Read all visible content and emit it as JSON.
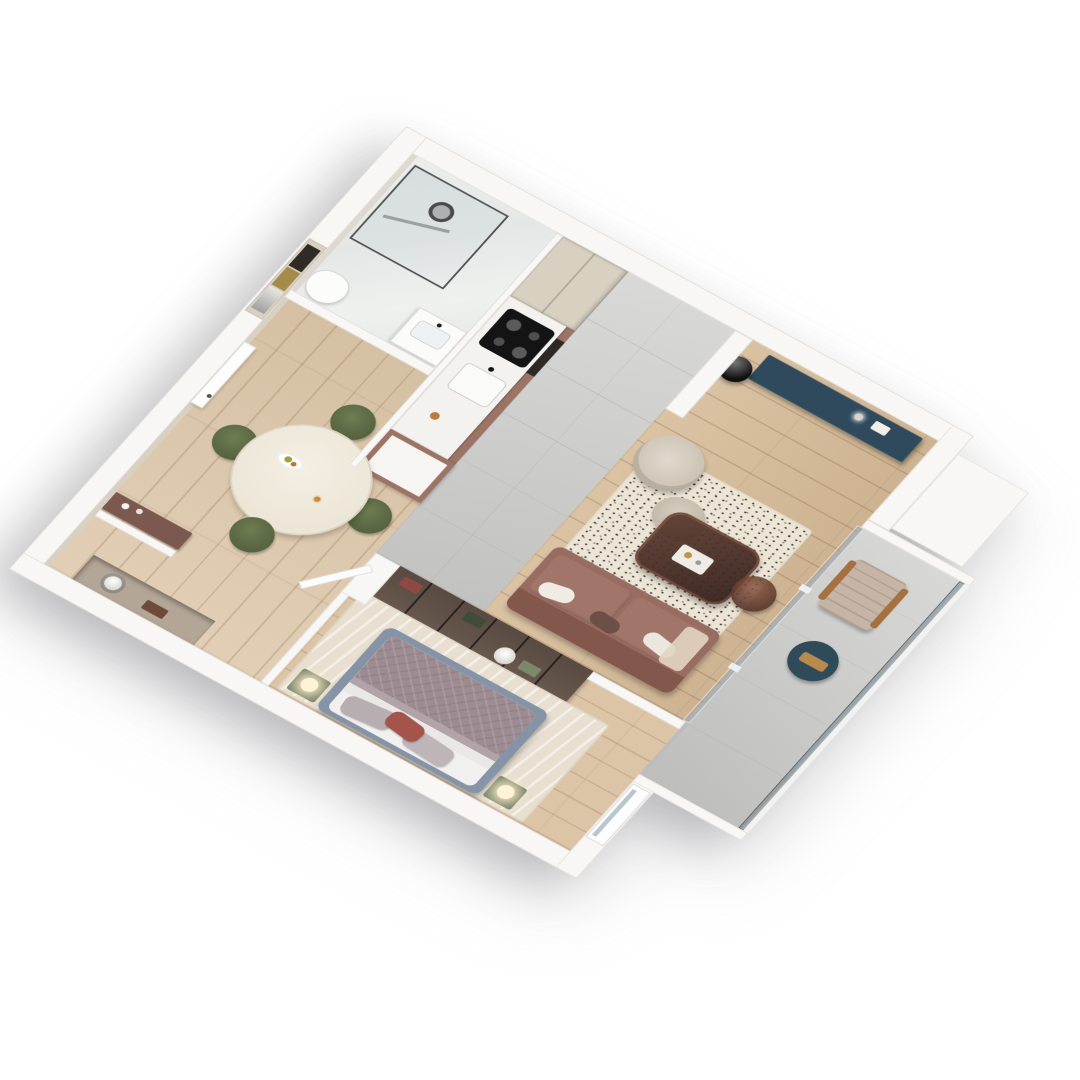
{
  "meta": {
    "type": "isometric-3d-floor-plan-render",
    "description": "Photorealistic 3D cutaway floor plan of a one-bedroom apartment viewed from above at an angle, white exterior walls, on a plain white background",
    "visible_text": "none"
  },
  "palette": {
    "wall": "#f8f7f5",
    "wallEdge": "#e1dfdb",
    "beigeWall": "#d8d0c0",
    "accentWall": "#aba49a",
    "concrete": "#cccccb",
    "woodHall": "#dcc6a8",
    "woodLiving": "#d5ba97",
    "woodBed": "#dcc4a7",
    "navy": "#2e4a5c",
    "sofa": "#986c60",
    "greenChair": "#5c6a45",
    "cream": "#d8d0c3",
    "rug": "#ece5d6",
    "bedRug": "#e8dfd1",
    "bedFrame": "#8493a6",
    "blanket": "#9c8b91",
    "redPillow": "#a5544c",
    "wardrobe": "#7a675a",
    "coffee": "#4e342c",
    "tower": "#9b7466",
    "counter": "#f3f2ee",
    "cab": "#d8d0c1",
    "balconyTable": "#2f4a59",
    "consoleBrown": "#7b5950",
    "niche": "#b4a697",
    "glass": "rgba(150,165,175,0.45)",
    "lamp": "#fff3d6",
    "marble": "#e9ebe9"
  },
  "rooms": {
    "bathroom": {
      "name": "Bathroom",
      "floor": "white marble",
      "items": [
        "walk-in glass shower",
        "black rain shower head",
        "wall shower bar",
        "toilet",
        "vanity with basin and mirror"
      ]
    },
    "kitchen": {
      "name": "Kitchen",
      "floor": "concrete tile",
      "items": [
        "tall beige cabinets",
        "white marble countertop",
        "induction cooktop",
        "built-in oven",
        "sink with black faucet",
        "mauve-brown cabinet tower"
      ]
    },
    "dining": {
      "name": "Dining area",
      "floor": "oak parquet",
      "items": [
        "round cream table",
        "four green upholstered chairs",
        "fruit plate",
        "drink glass",
        "brown wall console with decor"
      ]
    },
    "hallway": {
      "name": "Hallway",
      "floor": "oak parquet",
      "items": [
        "white entry door",
        "abstract wall art",
        "recessed niche console with bowl and box"
      ]
    },
    "living": {
      "name": "Living room",
      "floor": "oak plank",
      "items": [
        "textured gray accent wall with pin lights",
        "wood TV panel",
        "wall-mounted TV",
        "navy floating media console",
        "black glossy floor vase",
        "cream boucle lounge chair",
        "cream ottoman",
        "speckled cream rug",
        "dark glass coffee table with tray and candle",
        "brown glass side table",
        "terracotta sofa with pillows and throw"
      ]
    },
    "wardrobe": {
      "name": "Wardrobe partition",
      "items": [
        "smoked-glass wardrobe with folded linens",
        "interior warm lighting",
        "white plaster bowl decor"
      ]
    },
    "bedroom": {
      "name": "Bedroom",
      "floor": "oak plank",
      "items": [
        "double bed with blue-gray frame",
        "mauve quilted blanket",
        "two gray pillows",
        "terracotta accent pillow",
        "two green nightstands",
        "two glowing table lamps",
        "beige area rug",
        "white interior door",
        "window in outer wall"
      ]
    },
    "balcony": {
      "name": "Balcony",
      "floor": "concrete",
      "items": [
        "glass partition with sliding door",
        "beige lounge chair with wood armrests",
        "navy round side table with wood tray",
        "glass railing"
      ]
    }
  }
}
